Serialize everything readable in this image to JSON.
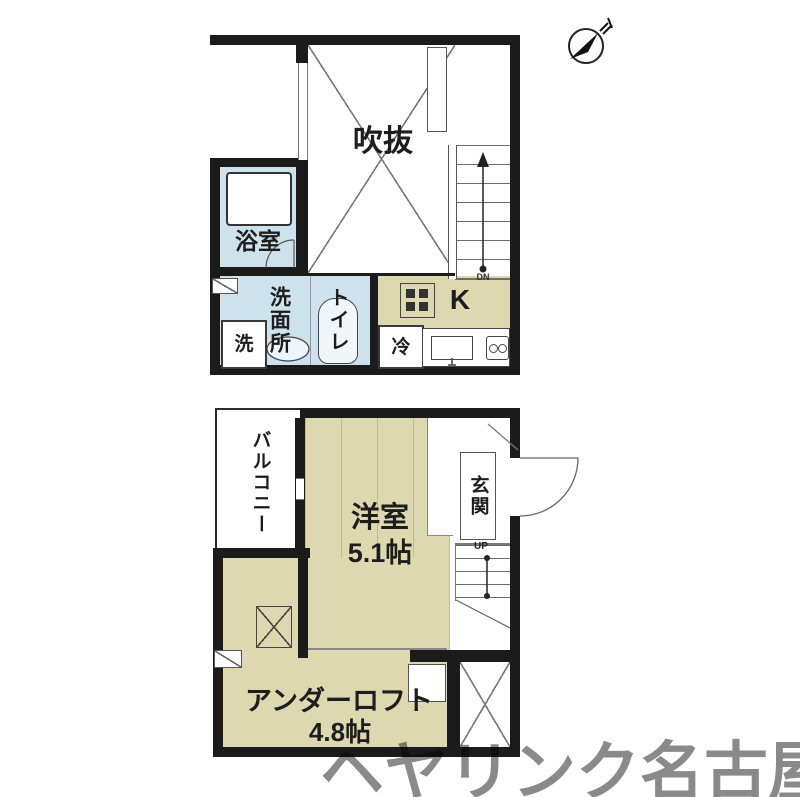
{
  "watermark": {
    "text": "ヘヤリンク名古屋"
  },
  "upper_floor": {
    "void": "吹抜",
    "bathroom": "浴室",
    "washroom": "洗面所",
    "toilet": "トイレ",
    "kitchen": "K",
    "washer": "洗",
    "refrigerator": "冷",
    "stairs_down": "DN"
  },
  "lower_floor": {
    "balcony": "バルコニー",
    "western_room": "洋室",
    "western_room_size": "5.1帖",
    "entrance": "玄関",
    "stairs_up": "UP",
    "under_loft": "アンダーロフト",
    "under_loft_size": "4.8帖"
  },
  "colors": {
    "wall": "#1b1b1b",
    "tatami_beige": "#ded8b0",
    "wet_area_blue": "#cde2ed",
    "watermark_gray": "#8a8a8a"
  }
}
